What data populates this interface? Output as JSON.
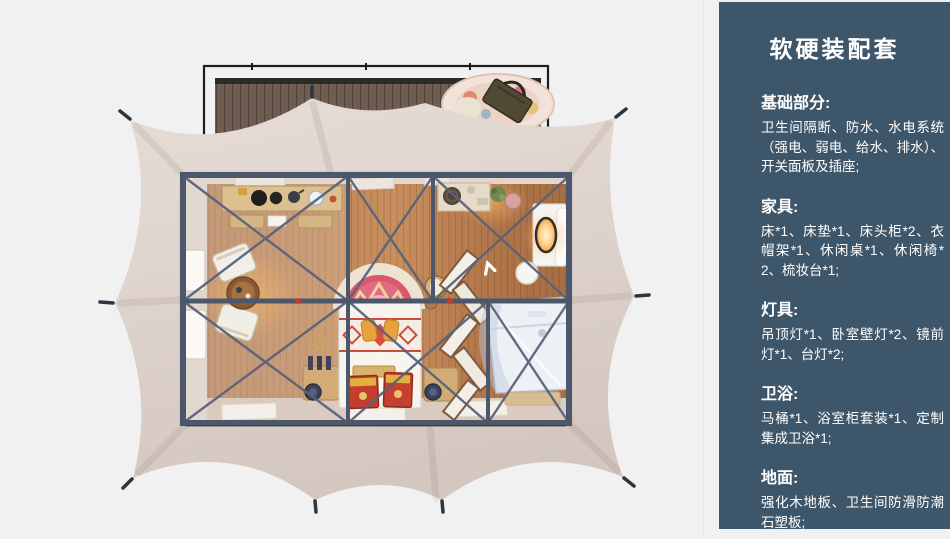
{
  "panel": {
    "title": "软硬装配套",
    "sections": [
      {
        "heading": "基础部分:",
        "body": "卫生间隔断、防水、水电系统（强电、弱电、给水、排水）、开关面板及插座;"
      },
      {
        "heading": "家具:",
        "body": "床*1、床垫*1、床头柜*2、衣帽架*1、休闲桌*1、休闲椅*2、梳妆台*1;"
      },
      {
        "heading": "灯具:",
        "body": "吊顶灯*1、卧室壁灯*2、镜前灯*1、台灯*2;"
      },
      {
        "heading": "卫浴:",
        "body": "马桶*1、浴室柜套装*1、定制集成卫浴*1;"
      },
      {
        "heading": "地面:",
        "body": "强化木地板、卫生间防滑防潮石塑板;"
      }
    ]
  },
  "scene": {
    "type": "top-down 3d floorplan render of a glamping tent suite",
    "elements": [
      "wood deck with railing",
      "scalloped beige tent canvas with stakes",
      "steel truss frame room",
      "lounge chairs with round table",
      "dressing desk",
      "bed with arched ethnic headboard rug",
      "red painted chests",
      "folding screen",
      "vanity with lit mirror",
      "integrated bathroom unit",
      "entry mats"
    ]
  },
  "colors": {
    "page_bg": "#f1f1f2",
    "panel_bg": "#3e566a",
    "canvas_light": "#e5dbd5",
    "canvas_dark": "#d5c9c2",
    "frame_steel": "#4d576b",
    "deck_wood": "#6e5d50",
    "floor_wood": "#c18a5a",
    "wall_band": "#e2d8d0",
    "joint_red": "#c23b2e",
    "bed_red": "#c43d2e",
    "rug_pink": "#dd5670"
  }
}
